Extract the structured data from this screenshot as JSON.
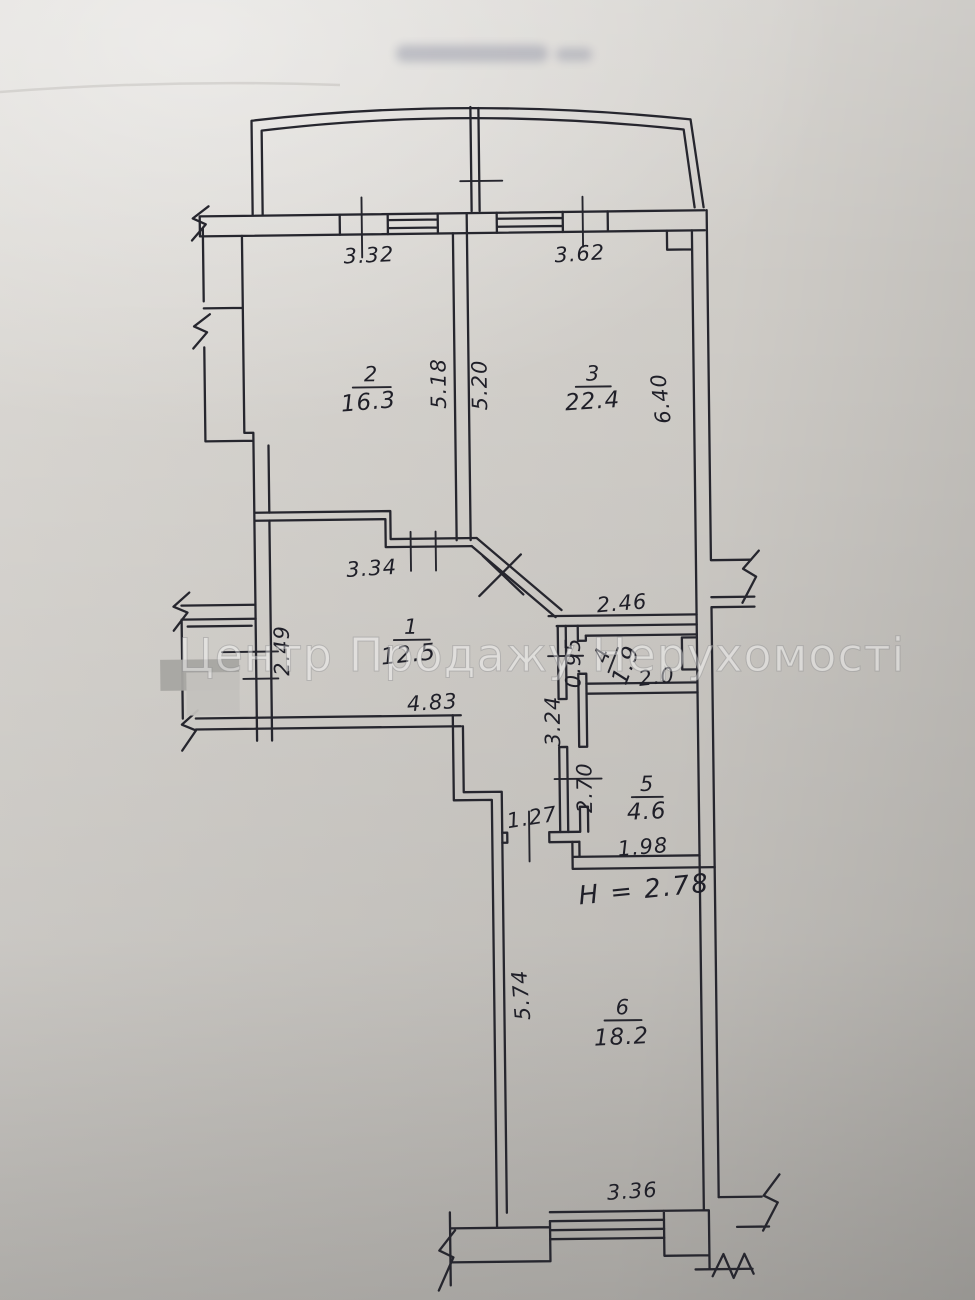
{
  "meta": {
    "kind": "scanned apartment floor plan photograph",
    "ink_color": "#26262e",
    "blue_ink_color": "#2c3a85",
    "paper_color": "#d7d4cf"
  },
  "watermark": {
    "text": "Центр Продажу Нерухомості"
  },
  "rooms": {
    "r1": {
      "number": "1",
      "area": "12.5"
    },
    "r2": {
      "number": "2",
      "area": "16.3"
    },
    "r3": {
      "number": "3",
      "area": "22.4"
    },
    "r4": {
      "number": "4",
      "area": "1.9"
    },
    "r5": {
      "number": "5",
      "area": "4.6"
    },
    "r6": {
      "number": "6",
      "area": "18.2"
    }
  },
  "dims": {
    "top_window_left": "3.32",
    "top_window_right": "3.62",
    "room2_depth_left": "5.18",
    "room2_depth_right": "5.20",
    "room3_depth": "6.40",
    "hall_top": "3.34",
    "room3_bottom": "2.46",
    "lobby_depth": "2.49",
    "hall_bottom": "4.83",
    "wc_door_side": "0.95",
    "wc_width": "2.0",
    "corridor_depth": "3.24",
    "bath_door_side": "2.70",
    "bath_width": "1.98",
    "hall_door": "1.27",
    "room6_depth": "5.74",
    "room6_width": "3.36"
  },
  "notes": {
    "ceiling_height": "H = 2.78"
  }
}
